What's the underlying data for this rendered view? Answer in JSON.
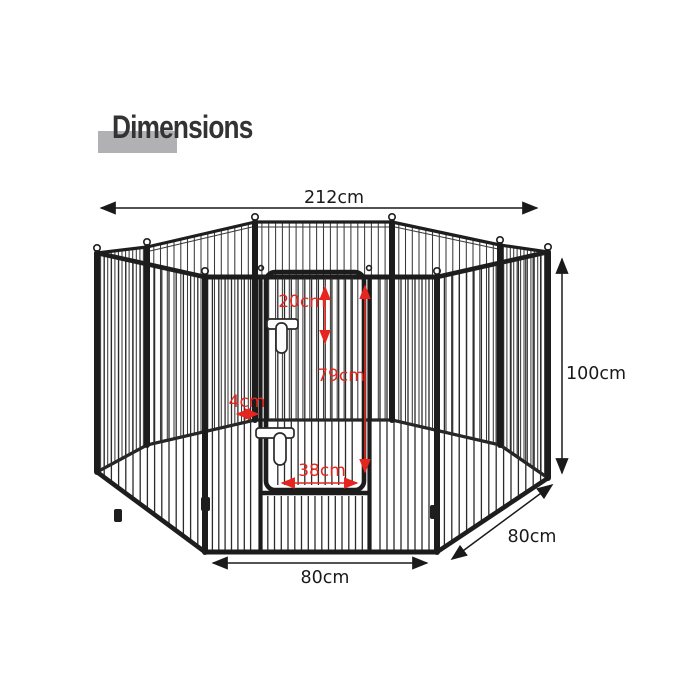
{
  "title": {
    "text": "Dimensions"
  },
  "colors": {
    "background": "#ffffff",
    "title_text": "#333333",
    "title_highlight": "#b1b1b4",
    "fence": "#1e1e1e",
    "dimension_line": "#1a1a1a",
    "dimension_red": "#e6251f"
  },
  "diagram": {
    "dimensions": {
      "overall_width": {
        "label": "212cm"
      },
      "panel_height": {
        "label": "100cm"
      },
      "side_panel_width": {
        "label": "80cm"
      },
      "front_panel_width": {
        "label": "80cm"
      },
      "door_top": {
        "label": "20cm"
      },
      "door_height": {
        "label": "79cm"
      },
      "door_gap": {
        "label": "4cm"
      },
      "door_width": {
        "label": "38cm"
      }
    }
  }
}
